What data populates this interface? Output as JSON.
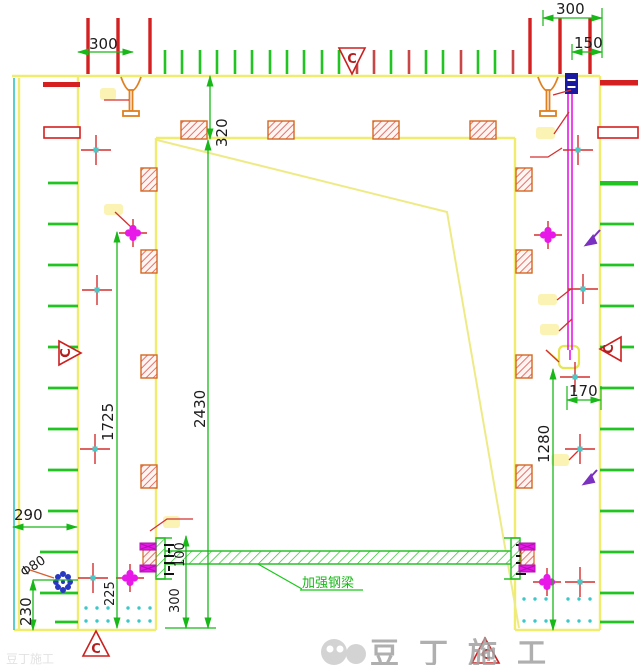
{
  "drawing": {
    "dims": {
      "d300_top_left": "300",
      "d300_top_right": "300",
      "d150": "150",
      "d320": "320",
      "d2430": "2430",
      "d1725": "1725",
      "d225": "225",
      "d290": "290",
      "d230": "230",
      "phi80": "Φ80",
      "d100": "100",
      "d300_bottom": "300",
      "d1280": "1280",
      "d170": "170"
    },
    "labels": {
      "beam": "加强钢梁"
    },
    "section_markers": {
      "top": "C",
      "left": "C",
      "right": "C",
      "bottom_left": "C",
      "bottom_right": "C"
    },
    "watermark": {
      "text": "豆丁施工",
      "text_partial": "豆丁施工"
    },
    "colors": {
      "wall_yellow": "#efec6e",
      "tick_green": "#22c422",
      "dim_green": "#18b818",
      "red": "#d43030",
      "hatch_red": "#e05050",
      "orange": "#e08020",
      "magenta": "#e818e8",
      "cyan": "#48c8c8",
      "blue": "#1a1aa0",
      "purple": "#7a30c0",
      "watermark_gray": "#a2a2a2"
    }
  }
}
